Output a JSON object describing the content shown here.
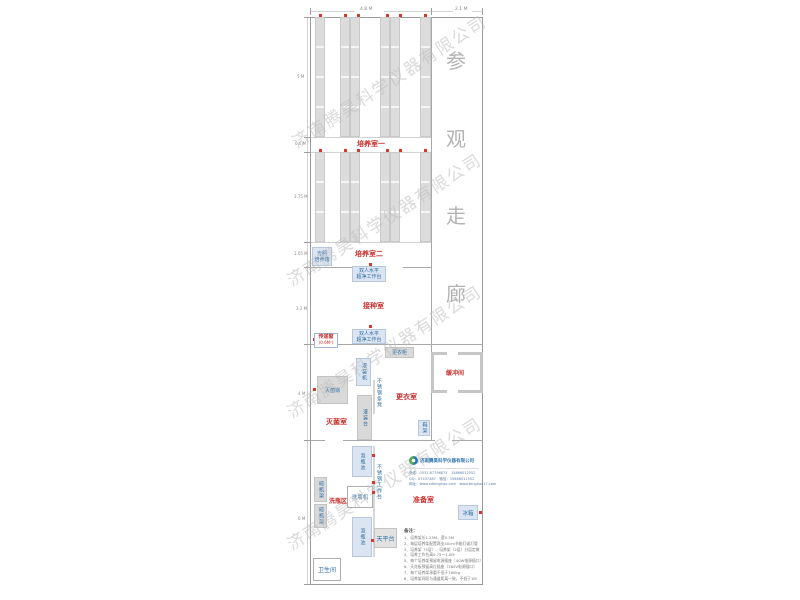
{
  "watermark": {
    "text": "济南腾昊科学仪器有限公司"
  },
  "dimensions": {
    "top": [
      "4.8 M",
      "2.1 M"
    ],
    "left": [
      "5 M",
      "0.6 M",
      "3.75 M",
      "1.05 M",
      "3.2 M",
      "4 M",
      "6 M"
    ]
  },
  "corridor": {
    "chars": [
      "参",
      "观",
      "走",
      "廊"
    ]
  },
  "rooms": {
    "culture1": "培养室一",
    "culture2": "培养室二",
    "inoculation": "接种室",
    "sterilization": "灭菌室",
    "changing": "更衣室",
    "buffer": "缓冲间",
    "washing_area": "洗瓶区",
    "preparation": "准备室",
    "toilet": "卫生间"
  },
  "equipment": {
    "light_incubator_l1": "光照",
    "light_incubator_l2": "培养箱",
    "clean_bench_l1": "双人水平",
    "clean_bench_l2": "超净工作台",
    "pass_window": "传递窗",
    "pass_window_size": "(0.6M²)",
    "wardrobe": "更衣柜",
    "filling_machine": "灌装机",
    "autoclave": "灭菌锅",
    "filling_table": "灌装台",
    "steel_bench": "不锈钢条凳",
    "shoe_rack": "鞋架",
    "soak_pool": "泡瓶池",
    "steel_worktable": "不锈钢工作台",
    "bottle_washer": "洗瓶机",
    "bottle_rack": "晾瓶架",
    "fridge": "冰箱",
    "balance_table": "天平台"
  },
  "company": {
    "name": "济南腾昊科学仪器有限公司",
    "phone": "电话：0531-87796871　15866012552",
    "qq": "QQ：57437487　微信：15866012552",
    "web": "网址：www.sdtenghao.com　www.tenghao17.com"
  },
  "notes": {
    "header": "备注：",
    "items": [
      "1、培养架长1.25M，宽0.5M",
      "2、每层培养架配置两支40cm节能灯或灯管",
      "3、培养架（5层）、培养架（2层）分层定做",
      "4、培养工作台高0.75～1.0M",
      "5、每个培养架预留电源插座（40W电源插口）",
      "6、天花板预留高位插座（380V电源插口）",
      "7、每个培养架承重不低于760kg",
      "8、培养架间距与通道距离一致，不低于1M"
    ]
  }
}
